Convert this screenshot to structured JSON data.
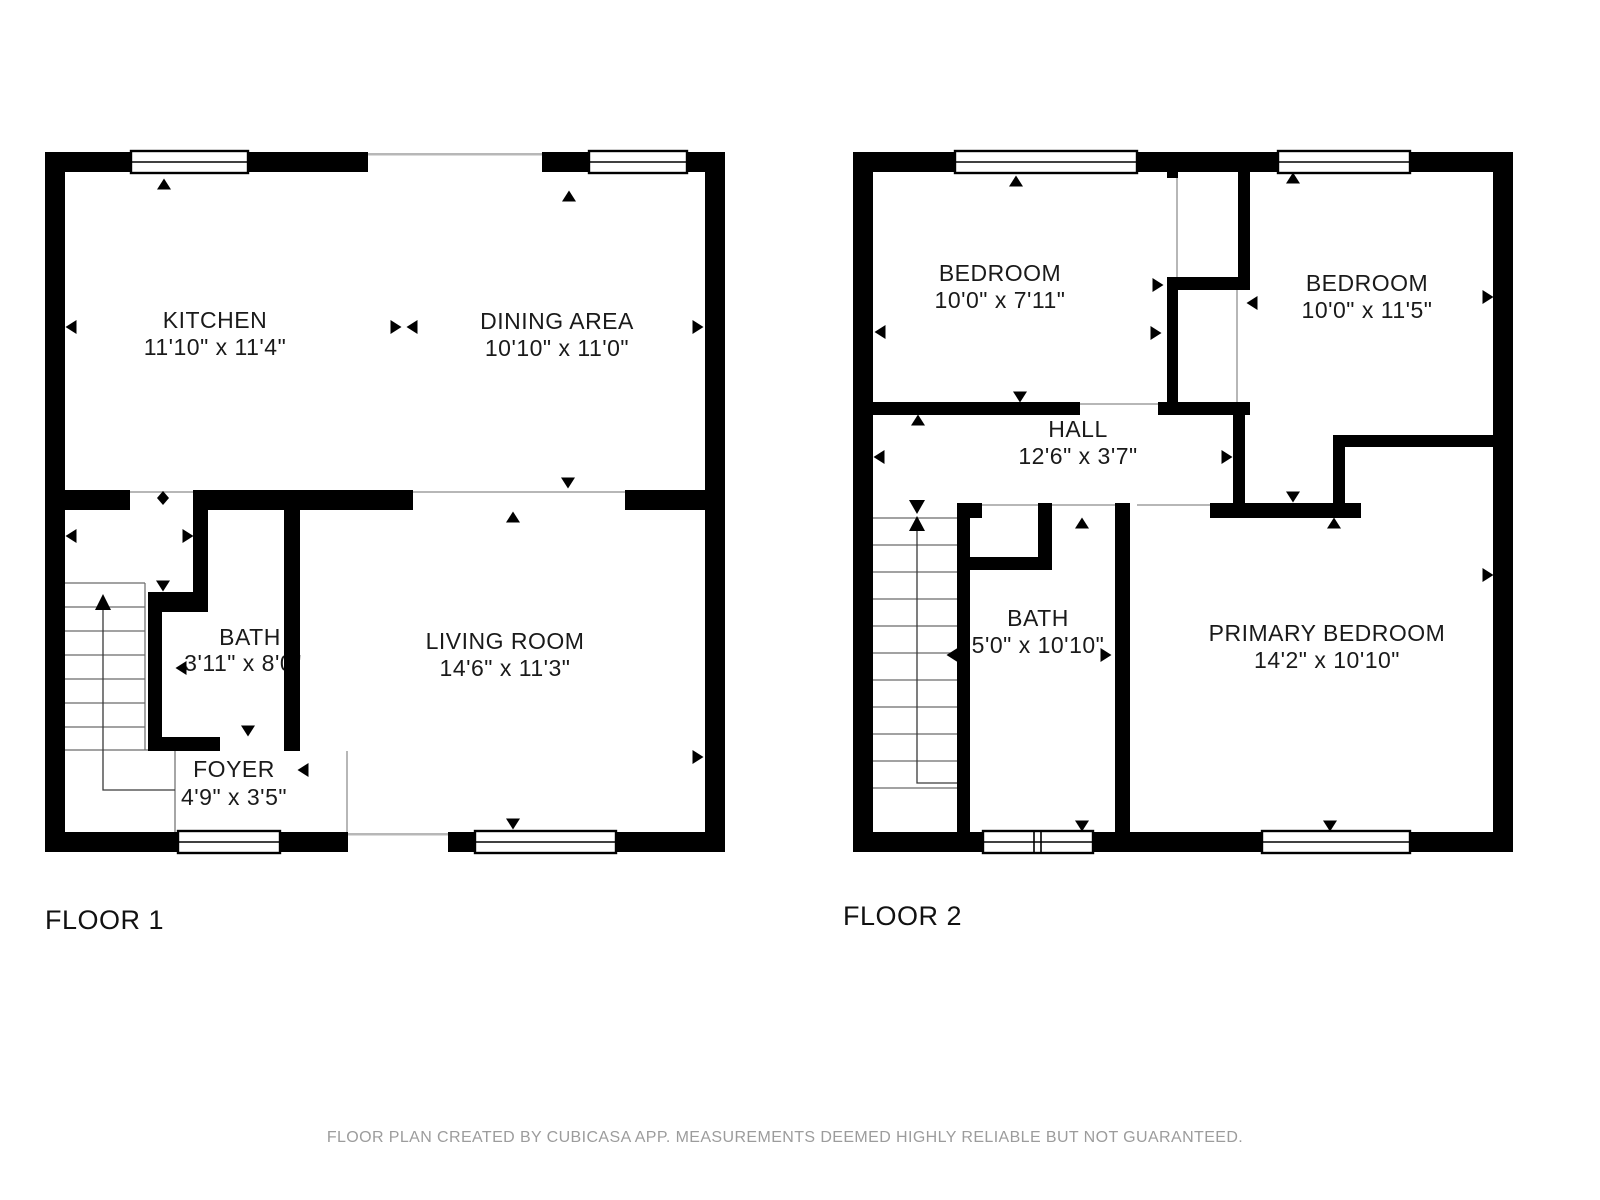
{
  "floors": [
    {
      "label": "FLOOR 1",
      "rooms": [
        {
          "name": "KITCHEN",
          "dims": "11'10\" x 11'4\""
        },
        {
          "name": "DINING AREA",
          "dims": "10'10\" x 11'0\""
        },
        {
          "name": "BATH",
          "dims": "3'11\" x 8'0\""
        },
        {
          "name": "LIVING ROOM",
          "dims": "14'6\" x 11'3\""
        },
        {
          "name": "FOYER",
          "dims": "4'9\" x 3'5\""
        }
      ]
    },
    {
      "label": "FLOOR 2",
      "rooms": [
        {
          "name": "BEDROOM",
          "dims": "10'0\" x 7'11\""
        },
        {
          "name": "BEDROOM",
          "dims": "10'0\" x 11'5\""
        },
        {
          "name": "HALL",
          "dims": "12'6\" x 3'7\""
        },
        {
          "name": "BATH",
          "dims": "5'0\" x 10'10\""
        },
        {
          "name": "PRIMARY BEDROOM",
          "dims": "14'2\" x 10'10\""
        }
      ]
    }
  ],
  "footer": "FLOOR PLAN CREATED BY CUBICASA APP. MEASUREMENTS DEEMED HIGHLY RELIABLE BUT NOT GUARANTEED.",
  "colors": {
    "wall": "#000000",
    "footer_text": "#9c9c9c",
    "opening_line": "#b7b7b7"
  }
}
